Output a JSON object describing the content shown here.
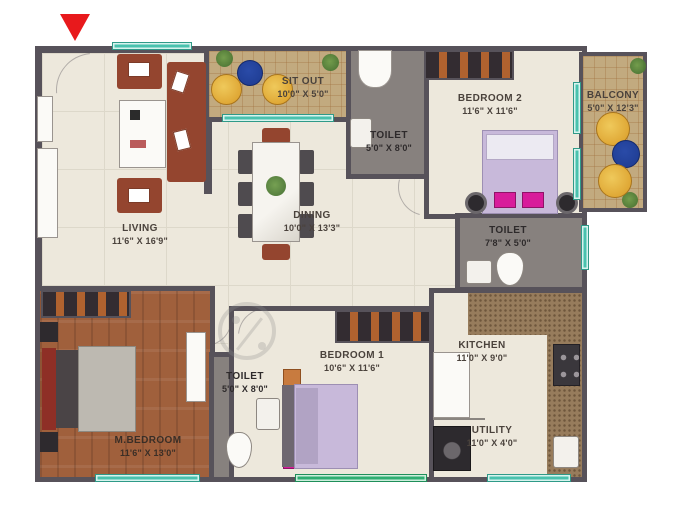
{
  "plan": {
    "title": "apartment-floor-plan",
    "rooms": [
      {
        "name": "LIVING",
        "dims": "11'6\" X 16'9\""
      },
      {
        "name": "SIT OUT",
        "dims": "10'0\" X 5'0\""
      },
      {
        "name": "TOILET",
        "dims": "5'0\" X 8'0\""
      },
      {
        "name": "BEDROOM 2",
        "dims": "11'6\" X 11'6\""
      },
      {
        "name": "BALCONY",
        "dims": "5'0\" X 12'3\""
      },
      {
        "name": "TOILET",
        "dims": "7'8\" X 5'0\""
      },
      {
        "name": "DINING",
        "dims": "10'0\" X 13'3\""
      },
      {
        "name": "BEDROOM 1",
        "dims": "10'6\" X 11'6\""
      },
      {
        "name": "M.BEDROOM",
        "dims": "11'6\" X 13'0\""
      },
      {
        "name": "TOILET",
        "dims": "5'0\" X 8'0\""
      },
      {
        "name": "KITCHEN",
        "dims": "11'0\" X 9'0\""
      },
      {
        "name": "UTILITY",
        "dims": "11'0\" X 4'0\""
      }
    ],
    "colors": {
      "wall": "#57525A",
      "floor": "#EDE8DC",
      "tile_tan": "#C2AA7F",
      "toilet_floor": "#87817E",
      "wood_floor": "#A0603C",
      "window_teal": "#49C2AE",
      "window_green": "#2FAE72",
      "entrance_marker_red": "#E8191C",
      "label_text": "#4A423C"
    }
  }
}
